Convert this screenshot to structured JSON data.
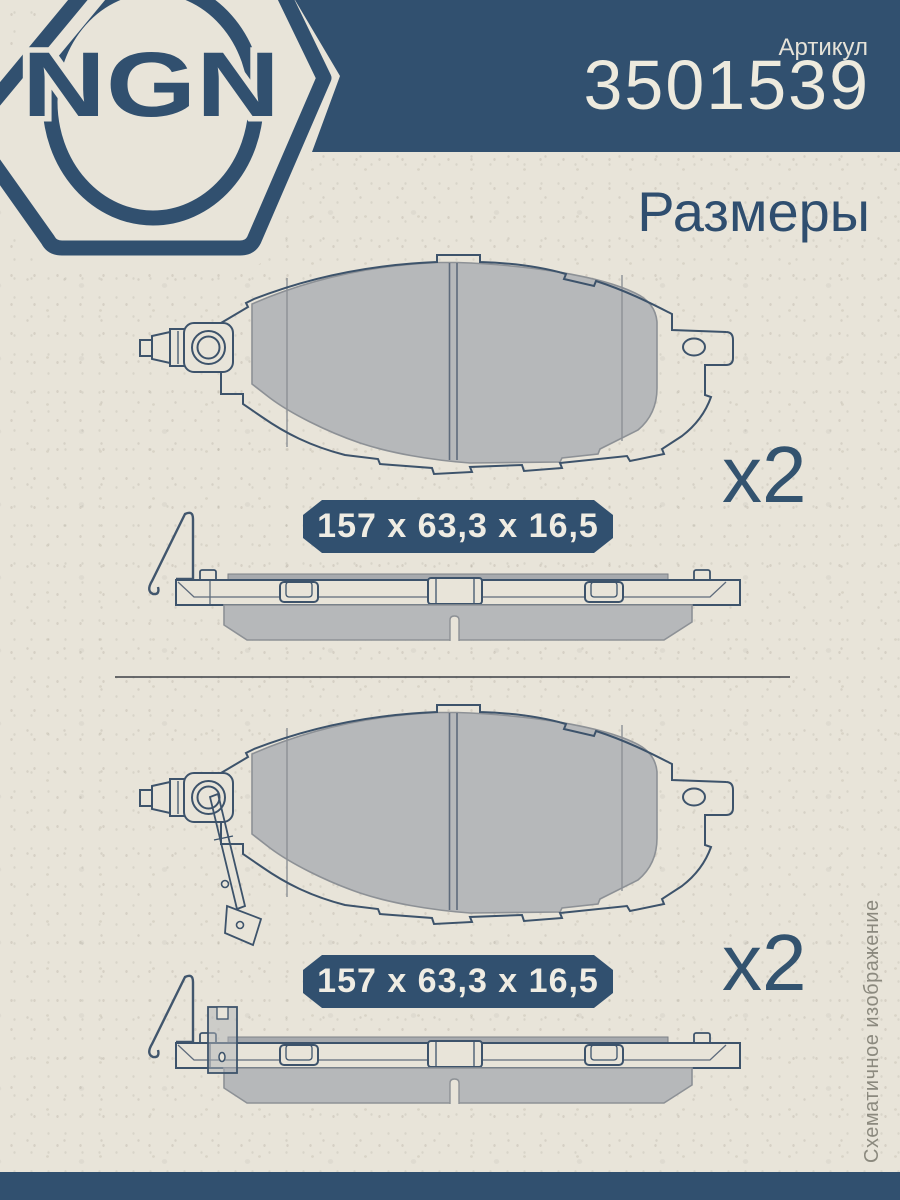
{
  "brand": {
    "logo_text": "NGN"
  },
  "header": {
    "article_label": "Артикул",
    "article_number": "3501539",
    "page_title": "Размеры"
  },
  "sections": [
    {
      "dimensions_label": "157 x 63,3 x 16,5",
      "quantity_label": "x2"
    },
    {
      "dimensions_label": "157 x 63,3 x 16,5",
      "quantity_label": "x2"
    }
  ],
  "sidebar_note": "Схематичное изображение",
  "colors": {
    "navy": "#31506f",
    "paper": "#e8e4d9",
    "pad_gray": "#b6b8ba",
    "line_navy": "#3d536b"
  }
}
